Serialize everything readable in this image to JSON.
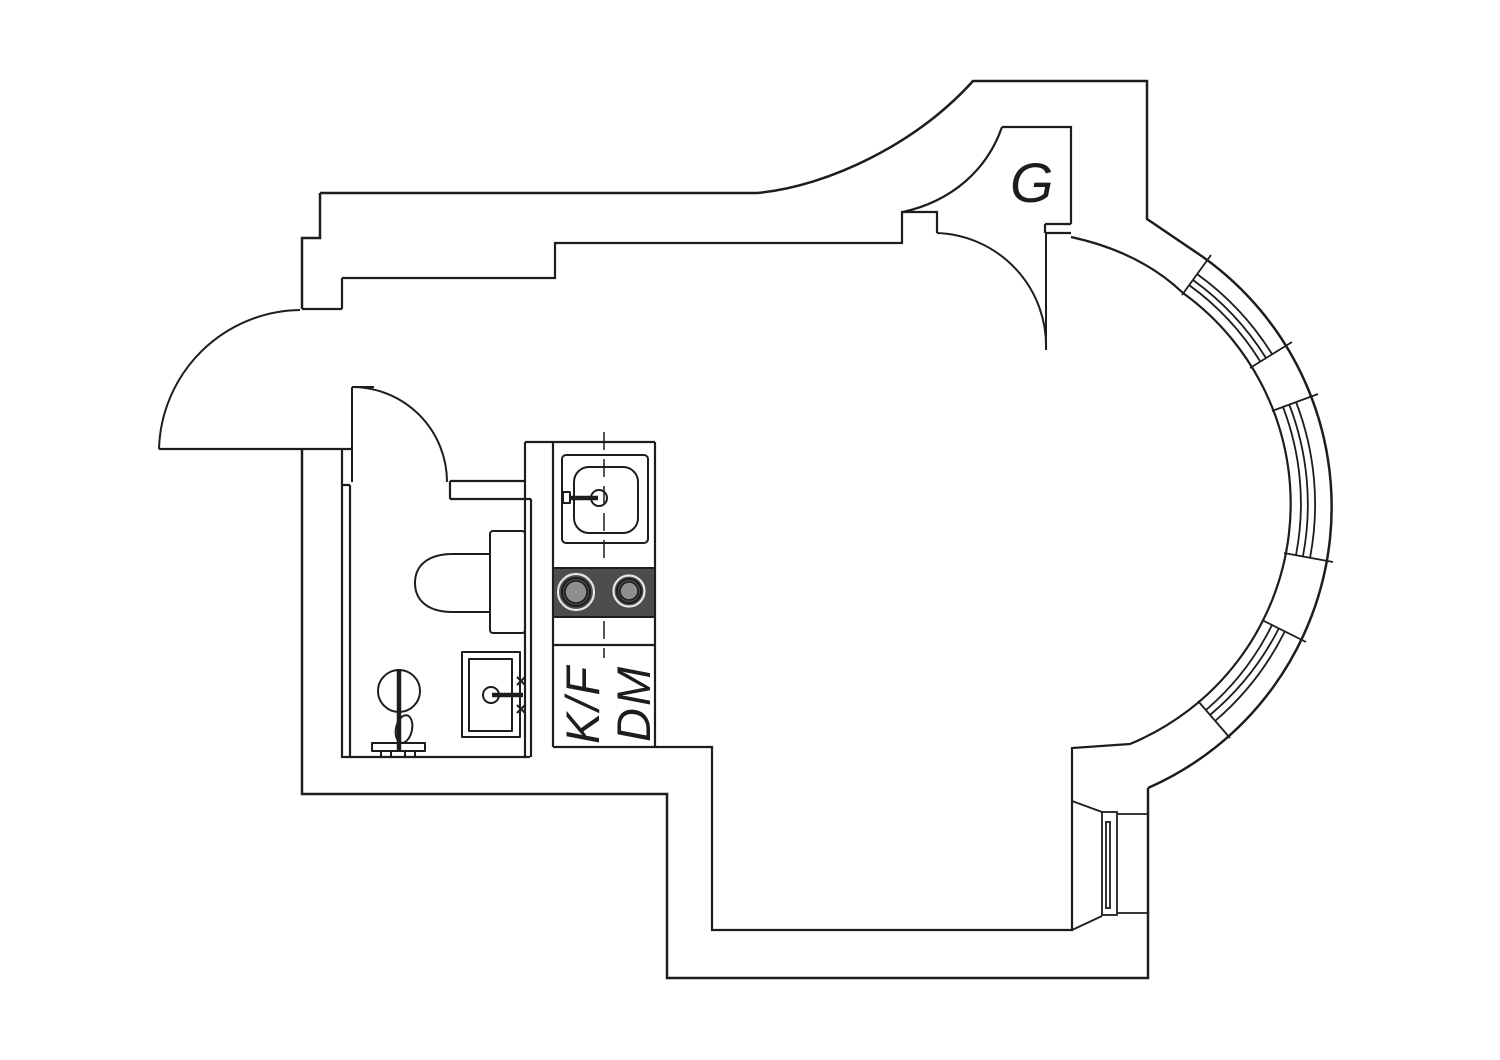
{
  "plan": {
    "labels": {
      "closet": "G",
      "fridge_freezer": "K/F",
      "dishwasher": "DM"
    },
    "colors": {
      "line": "#1d1d1b",
      "cooktop": "#4d4d4d",
      "burner_ring": "#e6e6e6",
      "burner_inner": "#8f8f8f",
      "background": "#ffffff"
    }
  }
}
